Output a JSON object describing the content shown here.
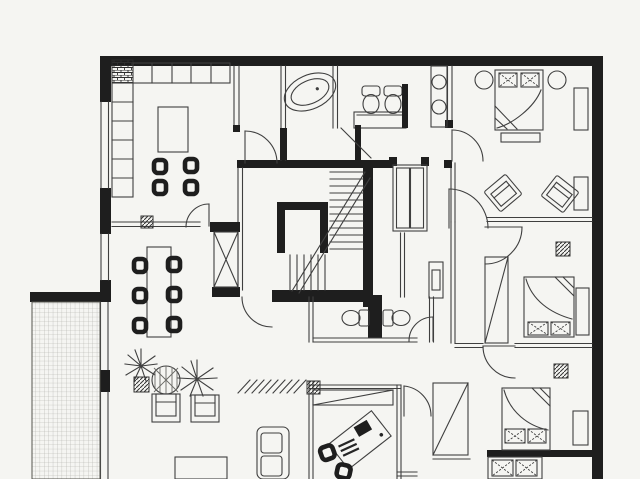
{
  "document": {
    "type": "architectural-floor-plan",
    "style": "scanned black-and-white apartment floor plan, no text labels"
  },
  "colors": {
    "paper": "#f5f5f2",
    "ink": "#3f3f3f",
    "wall": "#1e1e1e",
    "grid": "#b0b0aa"
  },
  "rooms": [
    {
      "id": "kitchen",
      "position": "top-left"
    },
    {
      "id": "dining-area",
      "position": "mid-left"
    },
    {
      "id": "living-area",
      "position": "bottom-left"
    },
    {
      "id": "terrace",
      "position": "bottom-left-edge",
      "finish": "tile-grid"
    },
    {
      "id": "main-bathroom",
      "position": "top-center"
    },
    {
      "id": "wc",
      "position": "center"
    },
    {
      "id": "stair-core",
      "position": "center"
    },
    {
      "id": "hallway",
      "position": "center"
    },
    {
      "id": "master-bedroom",
      "position": "top-right"
    },
    {
      "id": "bedroom-2",
      "position": "mid-right"
    },
    {
      "id": "bedroom-3",
      "position": "bottom-right"
    },
    {
      "id": "office",
      "position": "bottom-center"
    }
  ],
  "furniture": {
    "kitchen": [
      "counter-run-top",
      "counter-run-left",
      "appliance-block",
      "island-table",
      "chair",
      "chair",
      "chair",
      "chair"
    ],
    "dining_area": [
      "dining-table",
      "chair-x6"
    ],
    "living_area": [
      "armchair",
      "armchair",
      "sofa",
      "coffee-table",
      "palm-plant",
      "round-plant",
      "palm-plant",
      "planter-box",
      "floor-hatch-marks"
    ],
    "main_bathroom": [
      "bathtub",
      "toilet",
      "toilet",
      "vanity-counter",
      "double-sink-counter",
      "shower-screen"
    ],
    "wc": [
      "toilet",
      "toilet"
    ],
    "master_bedroom": [
      "double-bed",
      "pillow-x2",
      "round-side-table",
      "round-side-table",
      "foot-bench",
      "wardrobe",
      "side-cabinet",
      "lounge-chair",
      "lounge-chair"
    ],
    "bedroom_2": [
      "double-bed",
      "pillow-x2",
      "wardrobe",
      "side-cabinet",
      "hatch-marker"
    ],
    "bedroom_3": [
      "double-bed",
      "pillow-x2",
      "side-cabinet",
      "dresser-two-drawers",
      "hatch-marker"
    ],
    "office": [
      "desk-angled",
      "desk-chair",
      "side-chair",
      "closet-top",
      "closet-right"
    ],
    "hallway": [
      "hall-closet",
      "hall-cabinet"
    ]
  },
  "circulation": {
    "staircase": {
      "runs": 2,
      "treads_run1": 12,
      "treads_run2": 6
    },
    "elevator": {
      "symbol": "crossed-box"
    },
    "door_swings": 9,
    "windows_left_wall": 4
  }
}
